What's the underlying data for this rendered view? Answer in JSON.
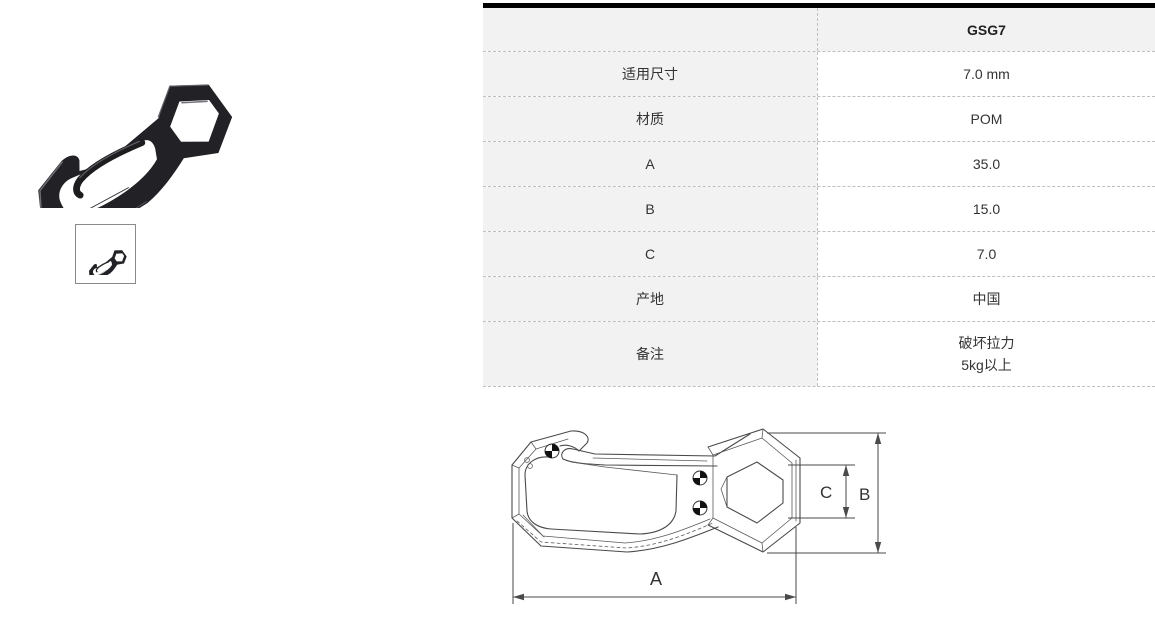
{
  "product": {
    "model": "GSG7",
    "photo_name": "black-plastic-snap-hook-photo",
    "thumbnail_name": "product-thumbnail"
  },
  "table": {
    "header_left": "",
    "header_right": "GSG7",
    "rows": [
      {
        "label": "适用尺寸",
        "lines": [
          "7.0 mm"
        ]
      },
      {
        "label": "材质",
        "lines": [
          "POM"
        ]
      },
      {
        "label": "A",
        "lines": [
          "35.0"
        ]
      },
      {
        "label": "B",
        "lines": [
          "15.0"
        ]
      },
      {
        "label": "C",
        "lines": [
          "7.0"
        ]
      },
      {
        "label": "产地",
        "lines": [
          "中国"
        ]
      },
      {
        "label": "备注",
        "lines": [
          "破坏拉力",
          "5kg以上"
        ]
      }
    ]
  },
  "drawing": {
    "label_a": "A",
    "label_b": "B",
    "label_c": "C"
  },
  "colors": {
    "table_top_bar": "#000000",
    "cell_gray": "#f2f2f2",
    "dashed_border": "#bfbfbf",
    "drawing_line": "#4a4a4a",
    "product_body": "#222226"
  }
}
